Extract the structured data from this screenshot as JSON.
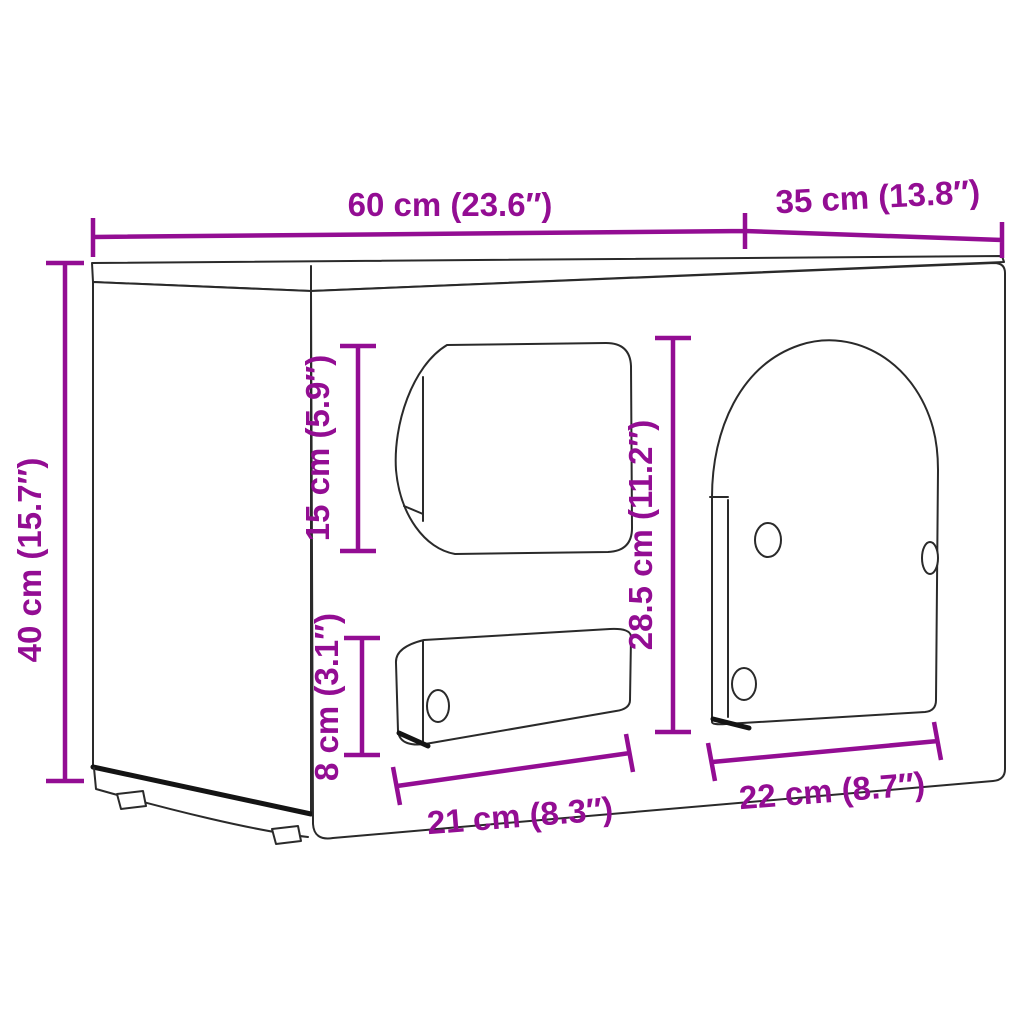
{
  "diagram": {
    "type": "furniture-dimension-diagram",
    "background_color": "#ffffff",
    "dimension_color": "#930d93",
    "outline_color": "#2a2a2a",
    "dimensions": {
      "width": {
        "cm": "60",
        "inches": "23.6",
        "label": "60 cm (23.6″)"
      },
      "depth": {
        "cm": "35",
        "inches": "13.8",
        "label": "35 cm (13.8″)"
      },
      "height": {
        "cm": "40",
        "inches": "15.7",
        "label": "40 cm (15.7″)"
      },
      "top_opening_height": {
        "cm": "15",
        "inches": "5.9",
        "label": "15 cm (5.9″)"
      },
      "door_opening_height": {
        "cm": "28.5",
        "inches": "11.2",
        "label": "28.5 cm (11.2″)"
      },
      "slot_opening_height": {
        "cm": "8",
        "inches": "3.1",
        "label": "8 cm (3.1″)"
      },
      "slot_opening_width": {
        "cm": "21",
        "inches": "8.3",
        "label": "21 cm (8.3″)"
      },
      "door_opening_width": {
        "cm": "22",
        "inches": "8.7",
        "label": "22 cm (8.7″)"
      }
    }
  }
}
